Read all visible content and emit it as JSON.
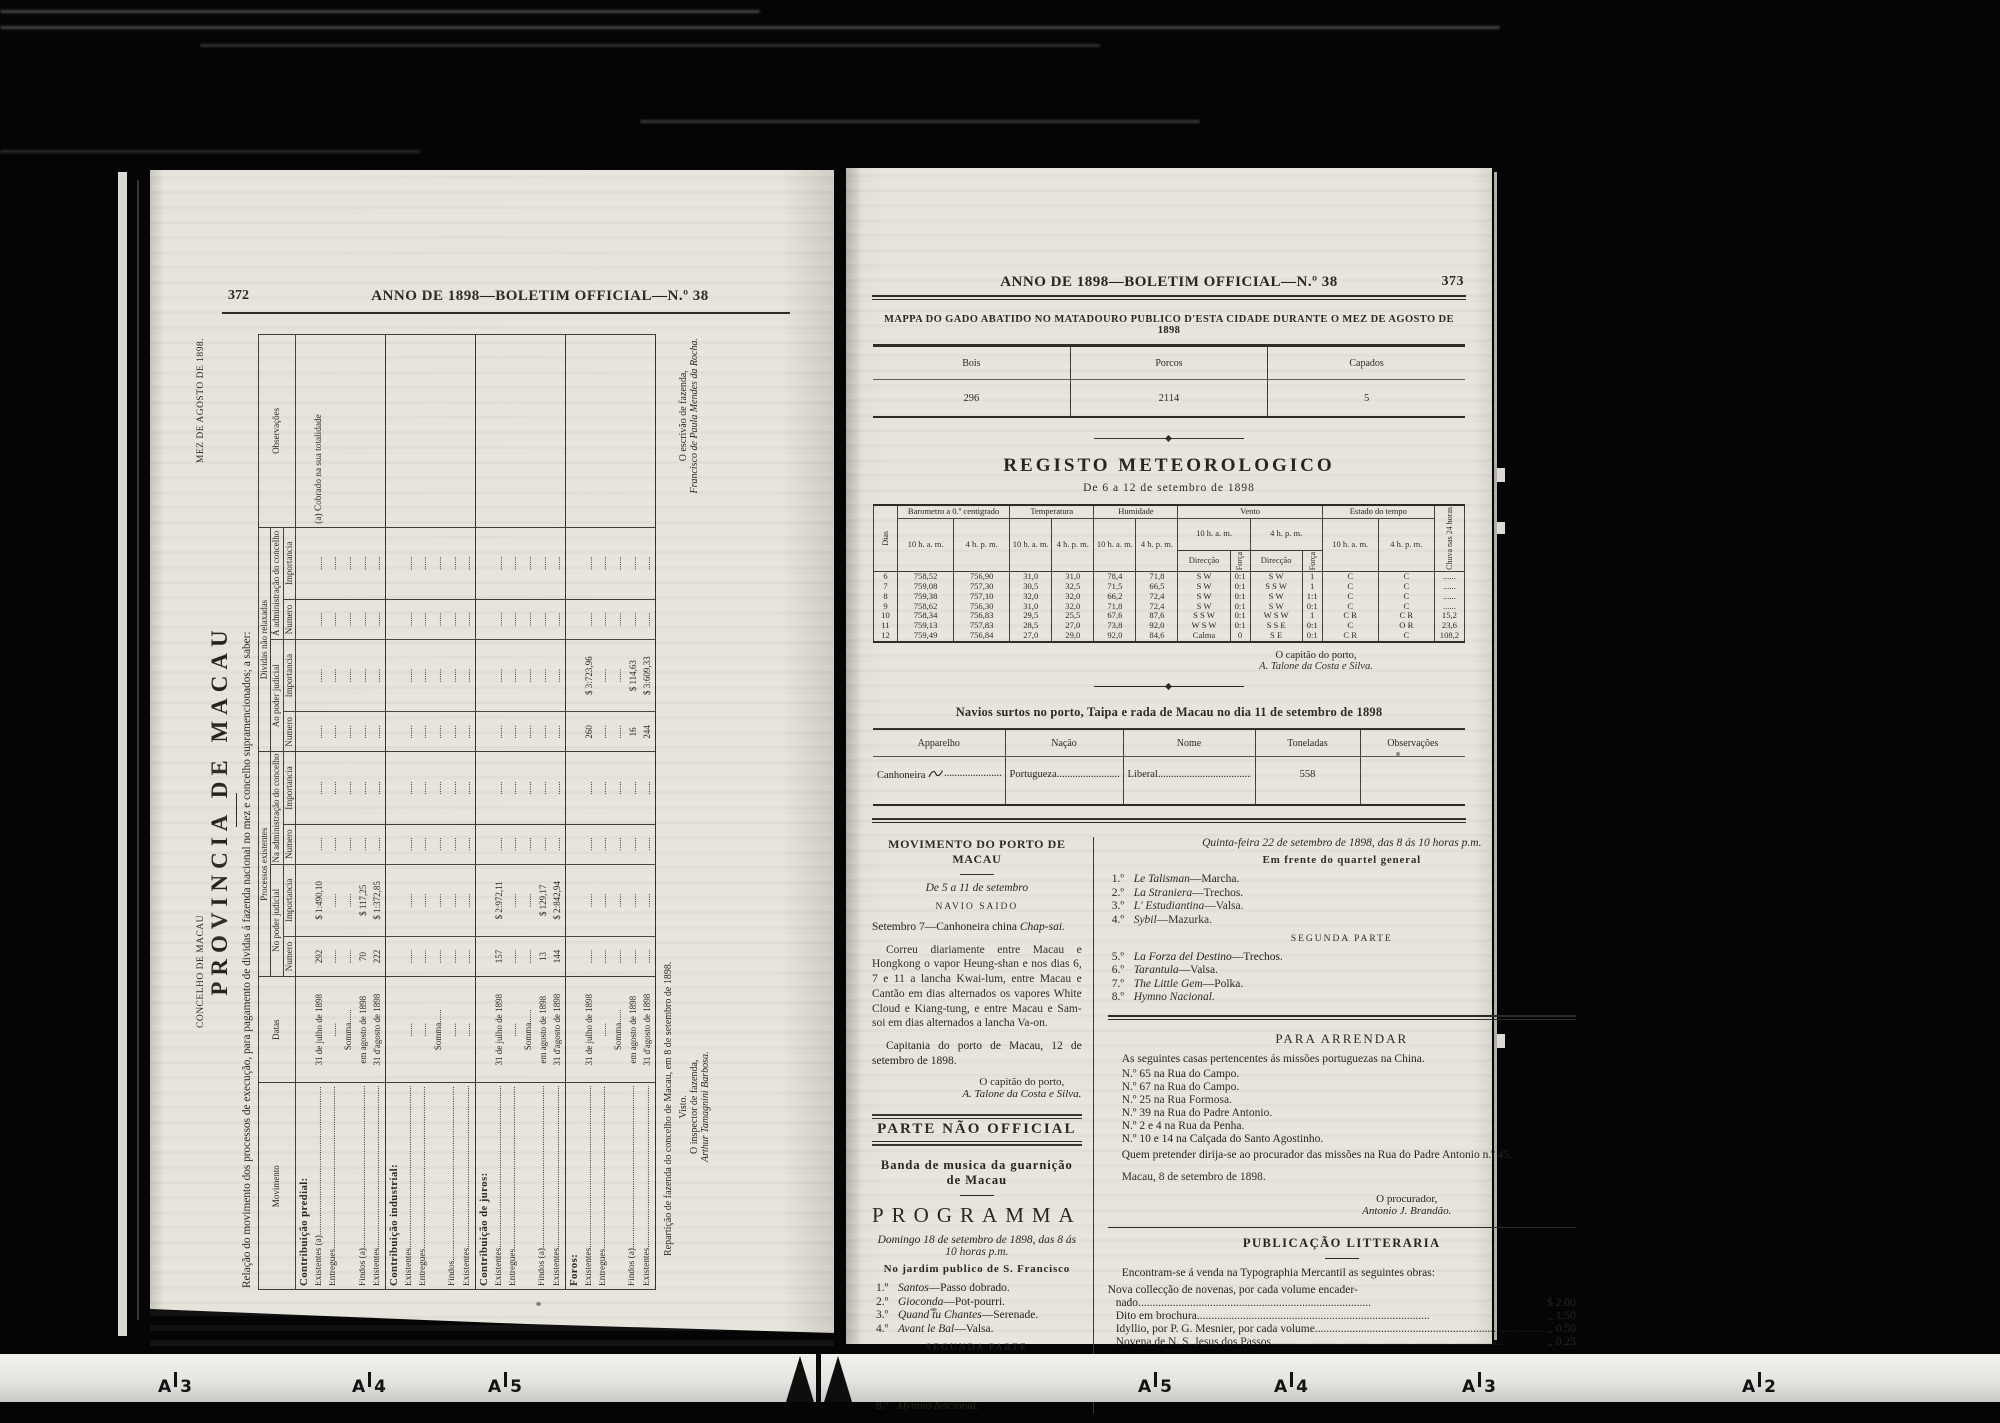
{
  "film": {
    "ruler": {
      "labels": [
        {
          "x": 158,
          "letter": "A",
          "num": "3"
        },
        {
          "x": 352,
          "letter": "A",
          "num": "4"
        },
        {
          "x": 488,
          "letter": "A",
          "num": "5"
        },
        {
          "x": 1138,
          "letter": "A",
          "num": "5"
        },
        {
          "x": 1274,
          "letter": "A",
          "num": "4"
        },
        {
          "x": 1462,
          "letter": "A",
          "num": "3"
        },
        {
          "x": 1742,
          "letter": "A",
          "num": "2"
        }
      ]
    }
  },
  "left_page": {
    "page_number": "372",
    "running_head": "ANNO DE 1898—BOLETIM OFFICIAL—N.º 38",
    "table": {
      "concelho": "CONCELHO DE MACAU",
      "mez": "MEZ DE AGOSTO DE 1898.",
      "provincia": "PROVINCIA DE MACAU",
      "relacao": "Relação do movimento dos processos de execução, para pagamento de dividas á fazenda nacional no mez e concelho supramencionados; a saber:",
      "headers": {
        "movimento": "Movimento",
        "datas": "Datas",
        "processos": "Processos existentes",
        "dividas": "Dividas não relaxadas",
        "npj": "No poder judicial",
        "nac": "Na administração do concelho",
        "apj": "Ao poder judicial",
        "aac": "Á administração do concelho",
        "numero": "Numero",
        "importancia": "Importancia",
        "observacoes": "Observações"
      },
      "sections": [
        {
          "title": "Contribuição predial:",
          "rows": [
            {
              "label": "Existentes (a)",
              "datas": "31 de julho de 1898",
              "cells": [
                "292",
                "$ 1:490,10",
                "......",
                "......",
                "......",
                "......",
                "......",
                "......"
              ],
              "obs": "(a) Cobrado na sua totalidade"
            },
            {
              "label": "Entregues",
              "datas": "......",
              "cells": [
                "......",
                "......",
                "......",
                "......",
                "......",
                "......",
                "......",
                "......"
              ],
              "obs": ""
            },
            {
              "label": "",
              "datas": "Somma......",
              "cells": [
                "......",
                "......",
                "......",
                "......",
                "......",
                "......",
                "......",
                "......"
              ],
              "obs": ""
            },
            {
              "label": "Findos (a)",
              "datas": "em agosto de 1898",
              "cells": [
                "70",
                "$ 117,25",
                "......",
                "......",
                "......",
                "......",
                "......",
                "......"
              ],
              "obs": ""
            },
            {
              "label": "Existentes",
              "datas": "31 d'agosto de 1898",
              "cells": [
                "222",
                "$ 1:372,85",
                "......",
                "......",
                "......",
                "......",
                "......",
                "......"
              ],
              "obs": ""
            }
          ]
        },
        {
          "title": "Contribuição industrial:",
          "rows": [
            {
              "label": "Existentes",
              "datas": "......",
              "cells": [
                "......",
                "......",
                "......",
                "......",
                "......",
                "......",
                "......",
                "......"
              ],
              "obs": ""
            },
            {
              "label": "Entregues",
              "datas": "......",
              "cells": [
                "......",
                "......",
                "......",
                "......",
                "......",
                "......",
                "......",
                "......"
              ],
              "obs": ""
            },
            {
              "label": "",
              "datas": "Somma......",
              "cells": [
                "......",
                "......",
                "......",
                "......",
                "......",
                "......",
                "......",
                "......"
              ],
              "obs": ""
            },
            {
              "label": "Findos",
              "datas": "......",
              "cells": [
                "......",
                "......",
                "......",
                "......",
                "......",
                "......",
                "......",
                "......"
              ],
              "obs": ""
            },
            {
              "label": "Existentes",
              "datas": "......",
              "cells": [
                "......",
                "......",
                "......",
                "......",
                "......",
                "......",
                "......",
                "......"
              ],
              "obs": ""
            }
          ]
        },
        {
          "title": "Contribuição de juros:",
          "rows": [
            {
              "label": "Existentes",
              "datas": "31 de julho de 1898",
              "cells": [
                "157",
                "$ 2:972,11",
                "......",
                "......",
                "......",
                "......",
                "......",
                "......"
              ],
              "obs": ""
            },
            {
              "label": "Entregues",
              "datas": "......",
              "cells": [
                "......",
                "......",
                "......",
                "......",
                "......",
                "......",
                "......",
                "......"
              ],
              "obs": ""
            },
            {
              "label": "",
              "datas": "Somma......",
              "cells": [
                "......",
                "......",
                "......",
                "......",
                "......",
                "......",
                "......",
                "......"
              ],
              "obs": ""
            },
            {
              "label": "Findos (a)",
              "datas": "em agosto de 1898",
              "cells": [
                "13",
                "$ 129,17",
                "......",
                "......",
                "......",
                "......",
                "......",
                "......"
              ],
              "obs": ""
            },
            {
              "label": "Existentes",
              "datas": "31 d'agosto de 1898",
              "cells": [
                "144",
                "$ 2:842,94",
                "......",
                "......",
                "......",
                "......",
                "......",
                "......"
              ],
              "obs": ""
            }
          ]
        },
        {
          "title": "Foros:",
          "rows": [
            {
              "label": "Existentes",
              "datas": "31 de julho de 1898",
              "cells": [
                "......",
                "......",
                "......",
                "......",
                "260",
                "$ 3:723,96",
                "......",
                "......"
              ],
              "obs": ""
            },
            {
              "label": "Entregues",
              "datas": "......",
              "cells": [
                "......",
                "......",
                "......",
                "......",
                "......",
                "......",
                "......",
                "......"
              ],
              "obs": ""
            },
            {
              "label": "",
              "datas": "Somma......",
              "cells": [
                "......",
                "......",
                "......",
                "......",
                "......",
                "......",
                "......",
                "......"
              ],
              "obs": ""
            },
            {
              "label": "Findos (a)",
              "datas": "em agosto de 1898",
              "cells": [
                "......",
                "......",
                "......",
                "......",
                "16",
                "$ 114,63",
                "......",
                "......"
              ],
              "obs": ""
            },
            {
              "label": "Existentes",
              "datas": "31 d'agosto de 1898",
              "cells": [
                "......",
                "......",
                "......",
                "......",
                "244",
                "$ 3:609,33",
                "......",
                "......"
              ],
              "obs": ""
            }
          ]
        }
      ],
      "footer": {
        "reparticao": "Repartição de fazenda do concelho de Macau, em 8 de setembro de 1898.",
        "visto": "Visto.",
        "inspector_role": "O inspector de fazenda,",
        "inspector_name": "Arthur Tamagnini Barbosa.",
        "escrivao_role": "O escrivão de fazenda,",
        "escrivao_name": "Francisco de Paula Mendes da Rocha."
      }
    }
  },
  "right_page": {
    "page_number": "373",
    "running_head": "ANNO DE 1898—BOLETIM OFFICIAL—N.º 38",
    "gado": {
      "title": "MAPPA DO GADO ABATIDO NO MATADOURO PUBLICO D'ESTA CIDADE DURANTE O MEZ DE AGOSTO DE 1898",
      "cols": [
        {
          "label": "Bois",
          "value": "296"
        },
        {
          "label": "Porcos",
          "value": "2114"
        },
        {
          "label": "Capados",
          "value": "5"
        }
      ]
    },
    "meteo": {
      "title": "REGISTO METEOROLOGICO",
      "subtitle": "De 6 a 12 de setembro de 1898",
      "headers": {
        "dias": "Dias",
        "baro": "Barometro a 0.º centigrado",
        "temp": "Temperatura",
        "hum": "Humidade",
        "vento": "Vento",
        "estado": "Estado do tempo",
        "chuva": "Chuva nas 24 horas",
        "h10": "10 h. a. m.",
        "h4": "4 h. p. m.",
        "dir": "Direcção",
        "forca": "Força"
      },
      "rows": [
        {
          "dia": "6",
          "v": [
            "758,52",
            "756,90",
            "31,0",
            "31,0",
            "78,4",
            "71,8",
            "S W",
            "0:1",
            "S W",
            "1",
            "C",
            "C",
            "......"
          ]
        },
        {
          "dia": "7",
          "v": [
            "759,08",
            "757,30",
            "30,5",
            "32,5",
            "71,5",
            "66,5",
            "S W",
            "0:1",
            "S S W",
            "1",
            "C",
            "C",
            "......"
          ]
        },
        {
          "dia": "8",
          "v": [
            "759,38",
            "757,10",
            "32,0",
            "32,0",
            "66,2",
            "72,4",
            "S W",
            "0:1",
            "S W",
            "1:1",
            "C",
            "C",
            "......"
          ]
        },
        {
          "dia": "9",
          "v": [
            "758,62",
            "756,30",
            "31,0",
            "32,0",
            "71,8",
            "72,4",
            "S W",
            "0:1",
            "S W",
            "0:1",
            "C",
            "C",
            "......"
          ]
        },
        {
          "dia": "10",
          "v": [
            "758,34",
            "756,83",
            "29,5",
            "25,5",
            "67,6",
            "87,6",
            "S S W",
            "0:1",
            "W S W",
            "1",
            "C R",
            "C R",
            "15,2"
          ]
        },
        {
          "dia": "11",
          "v": [
            "759,13",
            "757,83",
            "28,5",
            "27,0",
            "73,8",
            "92,0",
            "W S W",
            "0:1",
            "S S E",
            "0:1",
            "C",
            "O R",
            "23,6"
          ]
        },
        {
          "dia": "12",
          "v": [
            "759,49",
            "756,84",
            "27,0",
            "29,0",
            "92,0",
            "84,6",
            "Calma",
            "0",
            "S E",
            "0:1",
            "C R",
            "C",
            "108,2"
          ]
        }
      ],
      "sig_role": "O capitão do porto,",
      "sig_name": "A. Talone da Costa e Silva."
    },
    "navios": {
      "title": "Navios surtos no porto, Taipa e rada de Macau no dia 11 de setembro de 1898",
      "headers": [
        "Apparelho",
        "Nação",
        "Nome",
        "Toneladas",
        "Observações"
      ],
      "row": {
        "apparelho": "Canhoneira",
        "nacao": "Portugueza",
        "nome": "Liberal",
        "toneladas": "558",
        "obs": ""
      }
    },
    "movimento": {
      "heading": "MOVIMENTO DO PORTO DE MACAU",
      "period": "De 5 a 11 de setembro",
      "navio_saido": "NAVIO SAIDO",
      "saida_prefix": "Setembro 7—Canhoneira china ",
      "saida_ship": "Chap-sai.",
      "paragraph": "Correu diariamente entre Macau e Hongkong o vapor Heung-shan e nos dias 6, 7 e 11 a lancha Kwai-lum, entre Macau e Cantão em dias alternados os vapores White Cloud e Kiang-tung, e entre Macau e Sam-soi em dias alternados a lancha Va-on.",
      "capitania": "Capitania do porto de Macau, 12 de setembro de 1898.",
      "sig_role": "O capitão do porto,",
      "sig_name": "A. Talone da Costa e Silva."
    },
    "parte_nao_official": "PARTE NÃO OFFICIAL",
    "banda": "Banda de musica da guarnição de Macau",
    "programma": {
      "title": "PROGRAMMA",
      "date_line": "Domingo 18 de setembro de 1898, das 8 ás 10 horas p.m.",
      "venue": "No jardim publico de S. Francisco",
      "segunda": "SEGUNDA PARTE",
      "part1": [
        {
          "num": "1.º",
          "title": "Santos",
          "genre": "Passo dobrado."
        },
        {
          "num": "2.º",
          "title": "Gioconda",
          "genre": "Pot-pourri."
        },
        {
          "num": "3.º",
          "title": "Quand tu Chantes",
          "genre": "Serenade."
        },
        {
          "num": "4.º",
          "title": "Avant le Bal",
          "genre": "Valsa."
        }
      ],
      "part2": [
        {
          "num": "5.º",
          "title": "La Favorita",
          "genre": "Trechos."
        },
        {
          "num": "6.º",
          "title": "Fleurs du Printemps",
          "genre": "Valsa."
        },
        {
          "num": "7.º",
          "title": "Bald da bald dort",
          "genre": "Galope."
        },
        {
          "num": "8.º",
          "title": "Hymno Nacional.",
          "genre": ""
        }
      ]
    },
    "programma2": {
      "date_line": "Quinta-feira 22 de setembro de 1898, das 8 ás 10 horas p.m.",
      "venue": "Em frente do quartel general",
      "segunda": "SEGUNDA PARTE",
      "part1": [
        {
          "num": "1.º",
          "title": "Le Talisman",
          "genre": "Marcha."
        },
        {
          "num": "2.º",
          "title": "La Straniera",
          "genre": "Trechos."
        },
        {
          "num": "3.º",
          "title": "L' Estudiantina",
          "genre": "Valsa."
        },
        {
          "num": "4.º",
          "title": "Sybil",
          "genre": "Mazurka."
        }
      ],
      "part2": [
        {
          "num": "5.º",
          "title": "La Forza del Destino",
          "genre": "Trechos."
        },
        {
          "num": "6.º",
          "title": "Tarantula",
          "genre": "Valsa."
        },
        {
          "num": "7.º",
          "title": "The Little Gem",
          "genre": "Polka."
        },
        {
          "num": "8.º",
          "title": "Hymno Nacional.",
          "genre": ""
        }
      ]
    },
    "arrendar": {
      "title": "PARA ARRENDAR",
      "intro": "As seguintes casas pertencentes ás missões portuguezas na China.",
      "houses": [
        "N.º 65 na Rua do Campo.",
        "N.º 67 na Rua do Campo.",
        "N.º 25 na Rua Formosa.",
        "N.º 39 na Rua do Padre Antonio.",
        "N.º 2 e 4 na Rua da Penha.",
        "N.º 10 e 14 na Calçada do Santo Agostinho."
      ],
      "outro": "Quem pretender dirija-se ao procurador das missões na Rua do Padre Antonio n.º 45.",
      "place_date": "Macau, 8 de setembro de 1898.",
      "sig_role": "O procurador,",
      "sig_name": "Antonio J. Brandão."
    },
    "publicacao": {
      "title": "PUBLICAÇÃO LITTERARIA",
      "intro": "Encontram-se á venda na Typographia Mercantil as seguintes obras:",
      "lines": [
        {
          "text": "Nova collecção de novenas, por cada volume encader-",
          "price": ""
        },
        {
          "text": "nado",
          "price": "$ 2.00"
        },
        {
          "text": "Dito em brochura",
          "price": "„ 1.50"
        },
        {
          "text": "Idyllio, por P. G. Mesnier, por cada volume",
          "price": "„ 0.50"
        },
        {
          "text": "Novena de N. S. Jesus dos Passos",
          "price": "„ 0.25"
        }
      ]
    }
  }
}
